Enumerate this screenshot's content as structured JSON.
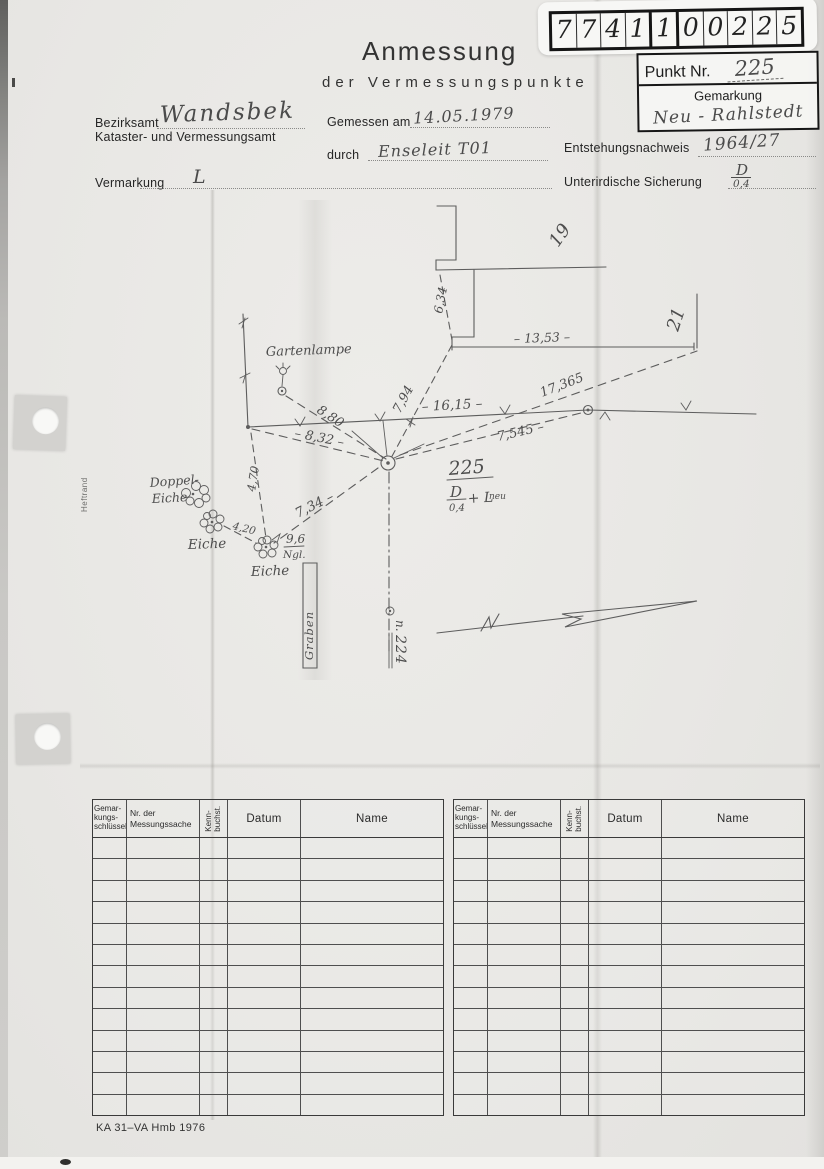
{
  "stamp": {
    "digits": [
      "7",
      "7",
      "4",
      "1",
      "1",
      "0",
      "0",
      "2",
      "2",
      "5"
    ],
    "punkt_label": "Punkt Nr.",
    "punkt_value": "225",
    "gemarkung_label": "Gemarkung",
    "gemarkung_value": "Neu - Rahlstedt"
  },
  "header": {
    "title": "Anmessung",
    "subtitle": "der Vermessungspunkte"
  },
  "form": {
    "bezirksamt_label": "Bezirksamt",
    "bezirksamt_value": "Wandsbek",
    "amt_label": "Kataster- und Vermessungsamt",
    "gemessen_label": "Gemessen am",
    "gemessen_value": "14.05.1979",
    "durch_label": "durch",
    "durch_value": "Enseleit T01",
    "entstehung_label": "Entstehungsnachweis",
    "entstehung_value": "1964/27",
    "vermarkung_label": "Vermarkung",
    "vermarkung_value": "L",
    "sicherung_label": "Unterirdische Sicherung",
    "sicherung_num": "D",
    "sicherung_den": "0,4"
  },
  "sketch": {
    "gartenlampe": "Gartenlampe",
    "doppel_line1": "Doppel-",
    "doppel_line2": "Eiche",
    "eiche2": "Eiche",
    "eiche3": "Eiche",
    "graben": "Graben",
    "house19": "19",
    "house21": "21",
    "m_1353": "– 13,53 –",
    "m_634": "6,34",
    "m_880": "8,80",
    "m_832": "– 8,32 –",
    "m_1615": "– 16,15 –",
    "m_794": "7,94",
    "m_17365": "17,365",
    "m_7545": "7,545 –",
    "m_470": "4,70",
    "m_734": "7,34 –",
    "m_420": "4,20",
    "ratio_num": "9,6",
    "ratio_den": "Ngl.",
    "point_label": "225",
    "frac_num": "D",
    "frac_den": "0,4",
    "frac_plus": "+ L",
    "frac_sup": "neu",
    "neighbor_prefix": "n.",
    "neighbor_value": "224",
    "heftrand": "Heftrand"
  },
  "table": {
    "headers": [
      "Gemar-\nkungs-\nschlüssel",
      "Nr. der\nMessungssache",
      "Kenn-\nbuchst.",
      "Datum",
      "Name"
    ],
    "row_count": 13
  },
  "footer": {
    "form_id": "KA 31–VA Hmb 1976"
  }
}
